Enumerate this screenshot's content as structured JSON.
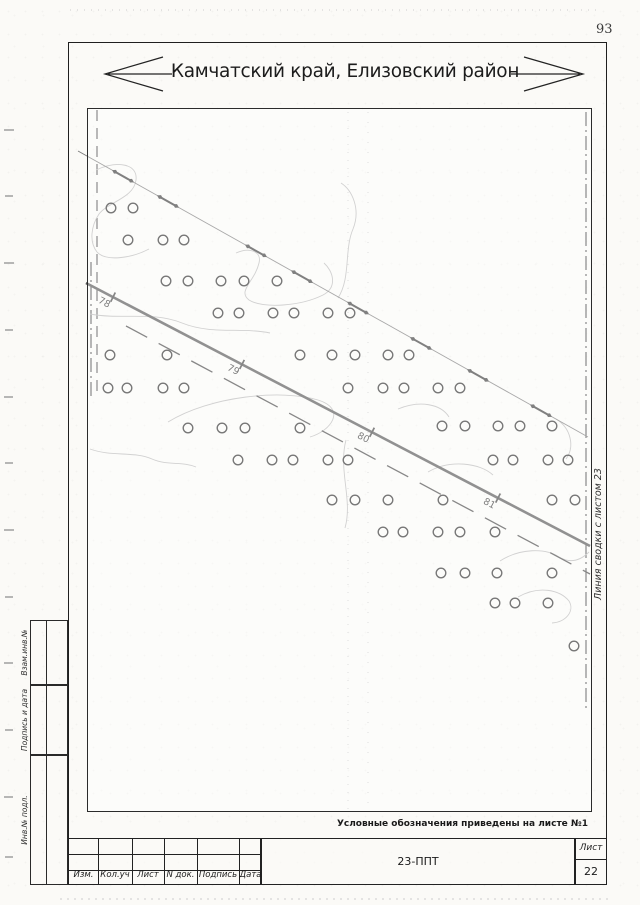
{
  "page": {
    "number": "93"
  },
  "header": {
    "region_title": "Камчатский край, Елизовский район"
  },
  "map": {
    "note": "Условные обозначения приведены на листе №1",
    "match_line_label": "Линия сводки с листом 23",
    "km_markers": [
      {
        "label": "78",
        "x": 113
      },
      {
        "label": "79",
        "x": 242
      },
      {
        "label": "80",
        "x": 372
      },
      {
        "label": "81",
        "x": 498
      }
    ],
    "survey_marker_pairs_x": [
      115,
      160,
      248,
      294,
      350,
      413,
      470,
      533
    ],
    "trees": [
      [
        111,
        208
      ],
      [
        133,
        208
      ],
      [
        128,
        240
      ],
      [
        163,
        240
      ],
      [
        184,
        240
      ],
      [
        166,
        281
      ],
      [
        188,
        281
      ],
      [
        221,
        281
      ],
      [
        244,
        281
      ],
      [
        277,
        281
      ],
      [
        218,
        313
      ],
      [
        239,
        313
      ],
      [
        273,
        313
      ],
      [
        294,
        313
      ],
      [
        328,
        313
      ],
      [
        350,
        313
      ],
      [
        110,
        355
      ],
      [
        167,
        355
      ],
      [
        300,
        355
      ],
      [
        332,
        355
      ],
      [
        355,
        355
      ],
      [
        388,
        355
      ],
      [
        409,
        355
      ],
      [
        108,
        388
      ],
      [
        127,
        388
      ],
      [
        163,
        388
      ],
      [
        184,
        388
      ],
      [
        348,
        388
      ],
      [
        383,
        388
      ],
      [
        404,
        388
      ],
      [
        438,
        388
      ],
      [
        460,
        388
      ],
      [
        188,
        428
      ],
      [
        222,
        428
      ],
      [
        245,
        428
      ],
      [
        300,
        428
      ],
      [
        442,
        426
      ],
      [
        465,
        426
      ],
      [
        498,
        426
      ],
      [
        520,
        426
      ],
      [
        552,
        426
      ],
      [
        238,
        460
      ],
      [
        272,
        460
      ],
      [
        293,
        460
      ],
      [
        328,
        460
      ],
      [
        348,
        460
      ],
      [
        493,
        460
      ],
      [
        513,
        460
      ],
      [
        548,
        460
      ],
      [
        568,
        460
      ],
      [
        332,
        500
      ],
      [
        355,
        500
      ],
      [
        388,
        500
      ],
      [
        443,
        500
      ],
      [
        552,
        500
      ],
      [
        575,
        500
      ],
      [
        383,
        532
      ],
      [
        403,
        532
      ],
      [
        438,
        532
      ],
      [
        460,
        532
      ],
      [
        495,
        532
      ],
      [
        441,
        573
      ],
      [
        465,
        573
      ],
      [
        497,
        573
      ],
      [
        552,
        573
      ],
      [
        495,
        603
      ],
      [
        515,
        603
      ],
      [
        548,
        603
      ],
      [
        574,
        646
      ]
    ],
    "geometry": {
      "road": {
        "x0": 86,
        "y0": 283,
        "k": 0.522,
        "x1": 590
      },
      "survey": {
        "x0": 78,
        "y0": 151,
        "k": 0.561,
        "x1": 588
      }
    }
  },
  "stamp_column": {
    "items": [
      "Взам.инв.№",
      "Подпись и дата",
      "Инв.№ подл."
    ]
  },
  "title_block": {
    "revision_columns": [
      "Изм.",
      "Кол.уч",
      "Лист",
      "N док.",
      "Подпись",
      "Дата"
    ],
    "document_code": "23-ППТ",
    "sheet_label": "Лист",
    "sheet_number": "22"
  }
}
